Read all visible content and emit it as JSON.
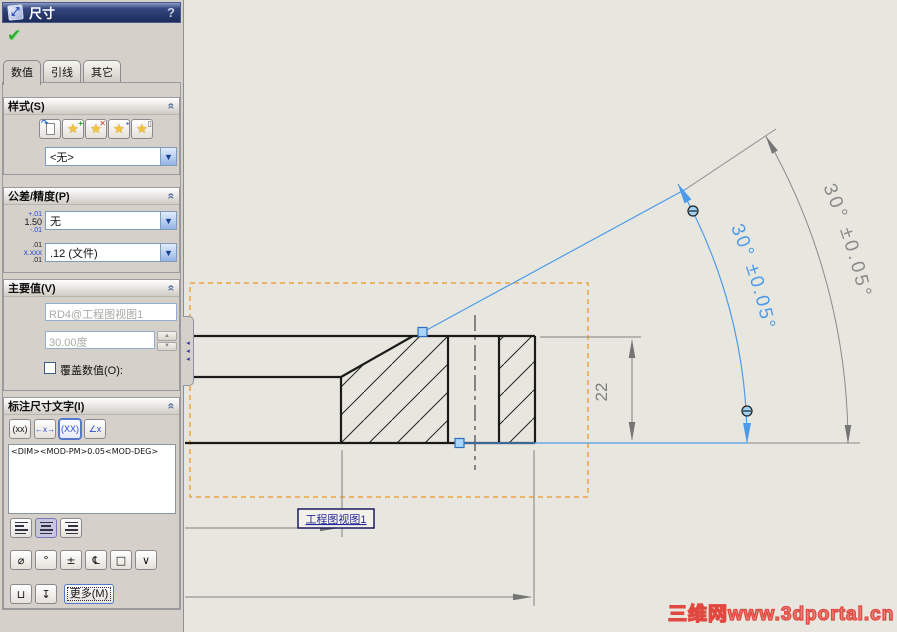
{
  "panel": {
    "title": "尺寸",
    "help_label": "?",
    "ok_icon": "✔",
    "title_icon": "⤢",
    "tabs": [
      {
        "label": "数值"
      },
      {
        "label": "引线"
      },
      {
        "label": "其它"
      }
    ],
    "style_section": {
      "header": "样式(S)",
      "chevron": "«",
      "buttons": {
        "apply_default": {
          "arrow": "↷"
        },
        "add": {
          "star": "★",
          "badge": "+",
          "color": "#1f9e1f"
        },
        "delete": {
          "star": "★",
          "badge": "✕",
          "color": "#d03020"
        },
        "save": {
          "star": "★",
          "badge": "▪",
          "color": "#2a5ad0"
        },
        "load": {
          "star": "★",
          "badge": "▯",
          "color": "#555"
        }
      },
      "dropdown_value": "<无>",
      "dropdown_arrow": "▼"
    },
    "tolerance_section": {
      "header": "公差/精度(P)",
      "chevron": "«",
      "icon1": {
        "top": "+.01",
        "mid": "1.50",
        "bot": "-.01"
      },
      "icon2": {
        "top": ".01",
        "mid": "x.xxx",
        "bot": ".01"
      },
      "tolerance_value": "无",
      "precision_value": ".12 (文件)",
      "dropdown_arrow": "▼"
    },
    "primary_section": {
      "header": "主要值(V)",
      "chevron": "«",
      "name_value": "RD4@工程图视图1",
      "dim_value": "30.00度",
      "spin_up": "▲",
      "spin_down": "▼",
      "override_label": "覆盖数值(O):"
    },
    "dimtext_section": {
      "header": "标注尺寸文字(I)",
      "chevron": "«",
      "buttons": [
        {
          "label": "(xx)"
        },
        {
          "label": "←x→"
        },
        {
          "label": "(XX)"
        },
        {
          "label": "∠x"
        }
      ],
      "text": "<DIM><MOD-PM>0.05<MOD-DEG>",
      "symbol_buttons": [
        "⌀",
        "°",
        "±",
        "℄",
        "□",
        "∨"
      ],
      "bottom_buttons": [
        "⊔",
        "↧"
      ],
      "more_label": "更多(M)"
    }
  },
  "drawing": {
    "angle_text": "30° ±0.05°",
    "dim_22": "22",
    "view_label": "工程图视图1",
    "watermark": "三维网www.3dportal.cn",
    "colors": {
      "background": "#e8e7df",
      "selected_blue": "#4d9be8",
      "dim_gray": "#8a8a8a",
      "view_border_orange": "#eda43c",
      "geometry_black": "#1a1a1a"
    }
  }
}
